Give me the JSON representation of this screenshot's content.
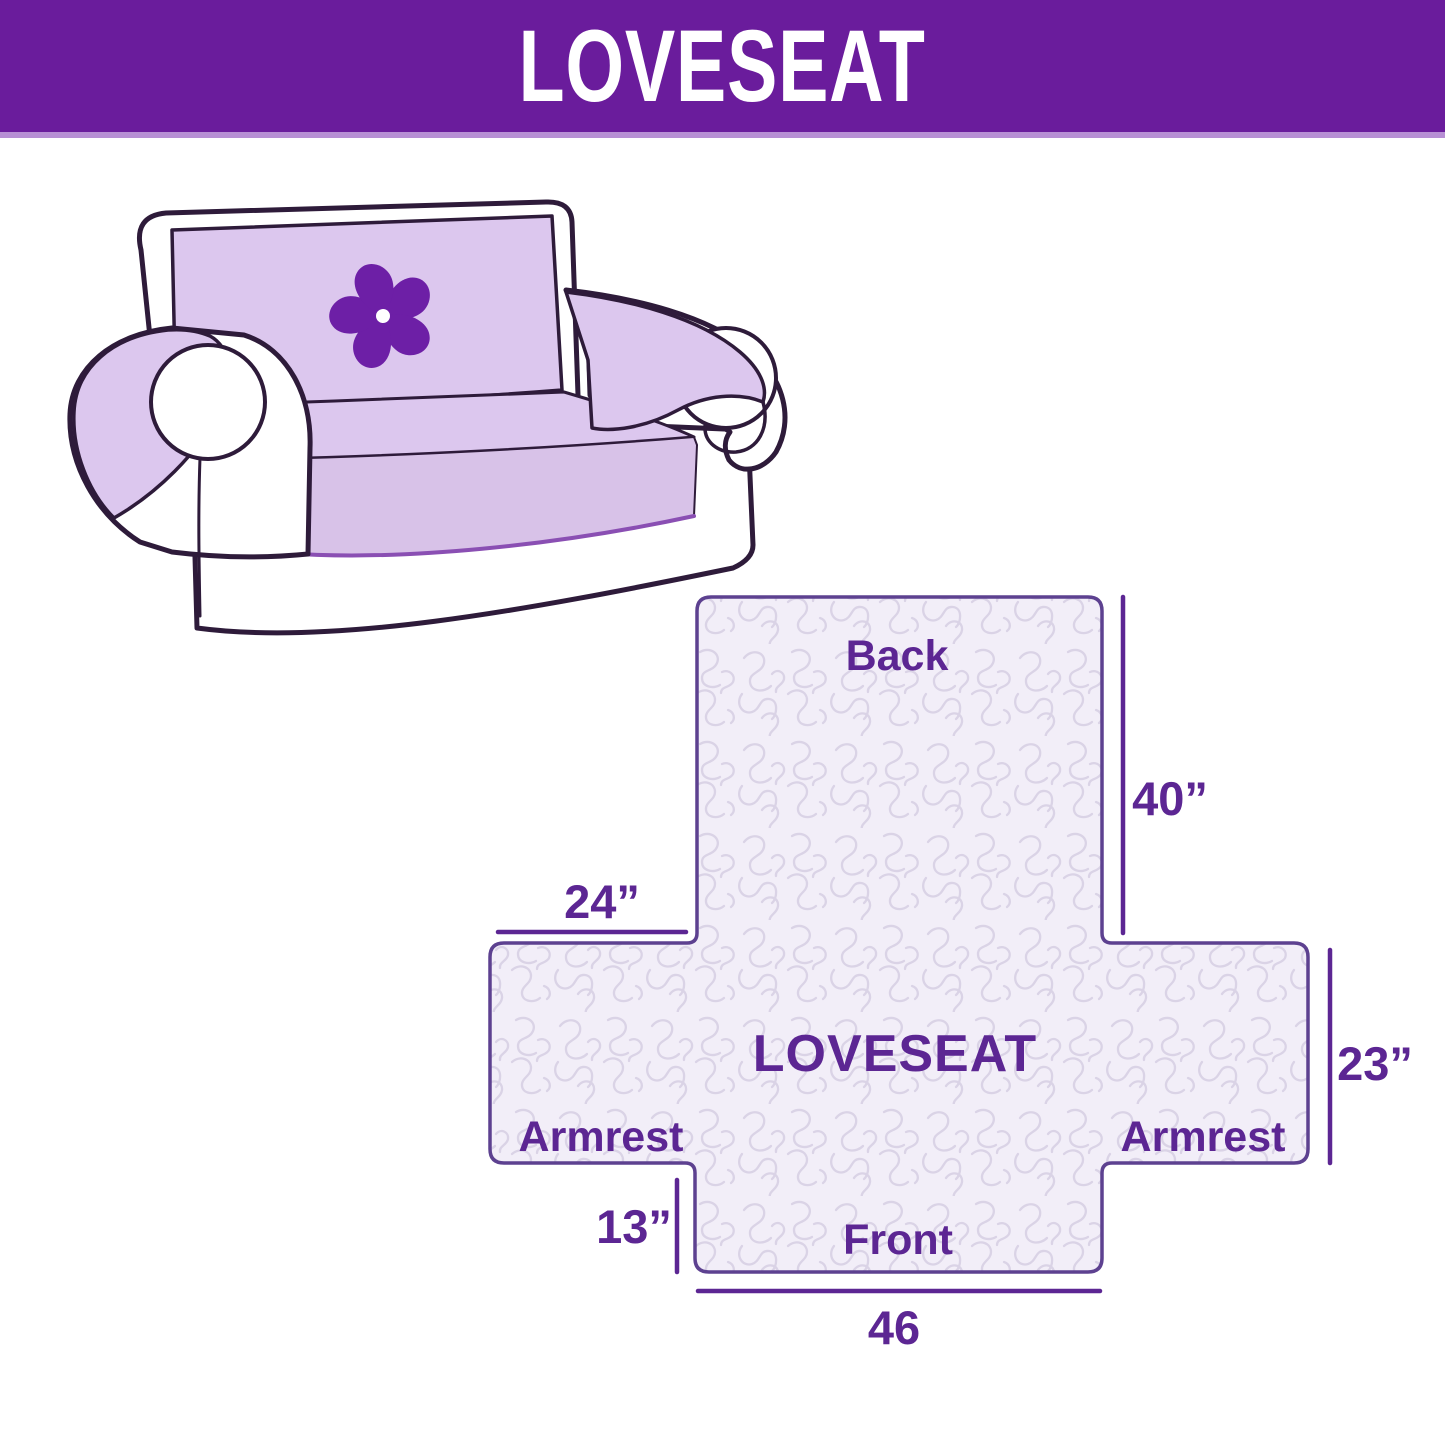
{
  "header": {
    "title": "LOVESEAT",
    "background_color": "#6A1C9C",
    "divider_color": "#B78FD4",
    "text_color": "#FFFFFF"
  },
  "illustration": {
    "description": "loveseat sofa with lavender slipcover and pinwheel logo",
    "cover_color": "#DCC7EE",
    "skirt_color": "#D8C2E8",
    "outline_color": "#2E1B3A",
    "cover_edge_color": "#8A4FB3",
    "logo_color": "#6D1FA6",
    "logo": "pinwheel-flower"
  },
  "diagram": {
    "center_label": "LOVESEAT",
    "back_label": "Back",
    "front_label": "Front",
    "armrest_left_label": "Armrest",
    "armrest_right_label": "Armrest",
    "dim_back_height": "40”",
    "dim_armrest_top_width": "24”",
    "dim_armrest_side_height": "23”",
    "dim_front_height": "13”",
    "dim_front_width": "46",
    "fill_color": "#F2EEF8",
    "pattern_line_color": "#DAD3E6",
    "outline_color": "#5D4190",
    "line_color": "#5C2693",
    "text_color": "#5C2693"
  }
}
